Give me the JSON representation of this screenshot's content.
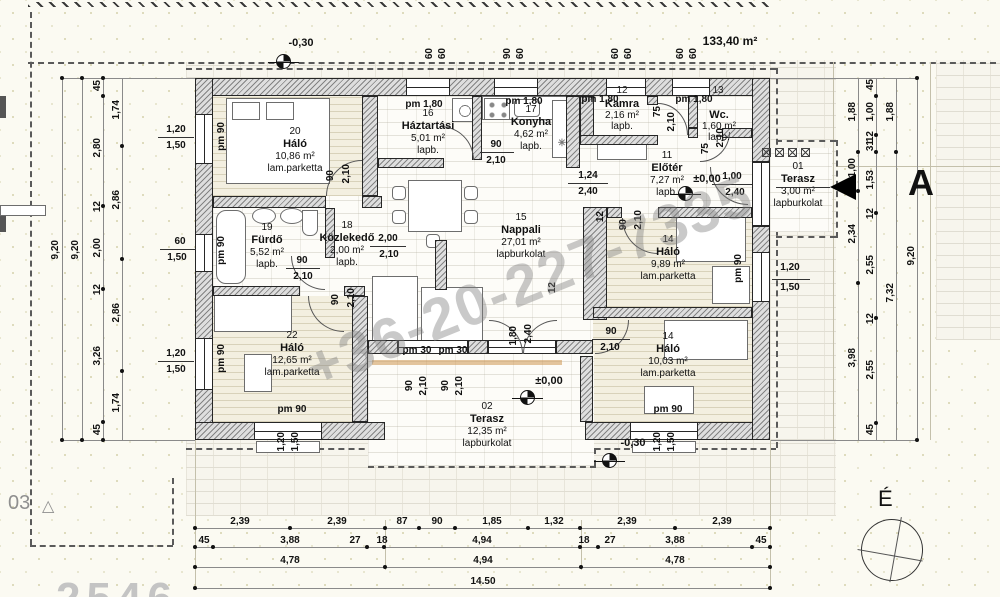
{
  "meta": {
    "area_total": "133,40 m²"
  },
  "levels": {
    "minus": "-0,30",
    "zero": "±0,00"
  },
  "watermark": "+36-20-227-7335",
  "marks": {
    "section": "A",
    "north": "É",
    "corner": "03",
    "partial": "2546"
  },
  "icons": {
    "triangle": "△",
    "boiler": "✳"
  },
  "rooms": {
    "r20": {
      "num": "20",
      "name": "Háló",
      "area": "10,86 m²",
      "floor": "lam.parketta"
    },
    "r16": {
      "num": "16",
      "name": "Háztartási",
      "area": "5,01 m²",
      "floor": "lapb."
    },
    "r17": {
      "num": "17",
      "name": "Konyha",
      "area": "4,62 m²",
      "floor": "lapb."
    },
    "r12": {
      "num": "12",
      "name": "Kamra",
      "area": "2,16 m²",
      "floor": "lapb."
    },
    "r13": {
      "num": "13",
      "name": "Wc.",
      "area": "1,60 m²",
      "floor": "lapb."
    },
    "r11": {
      "num": "11",
      "name": "Előtér",
      "area": "7,27 m²",
      "floor": "lapb."
    },
    "r15": {
      "num": "15",
      "name": "Nappali",
      "area": "27,01 m²",
      "floor": "lapburkolat"
    },
    "r19": {
      "num": "19",
      "name": "Fürdő",
      "area": "5,52 m²",
      "floor": "lapb."
    },
    "r18": {
      "num": "18",
      "name": "Közlekedő",
      "area": "2,00 m²",
      "floor": "lapb."
    },
    "r22": {
      "num": "22",
      "name": "Háló",
      "area": "12,65 m²",
      "floor": "lam.parketta"
    },
    "r14a": {
      "num": "14",
      "name": "Háló",
      "area": "9,89 m²",
      "floor": "lam.parketta"
    },
    "r14b": {
      "num": "14",
      "name": "Háló",
      "area": "10,03 m²",
      "floor": "lam.parketta"
    },
    "t01": {
      "num": "01",
      "name": "Terasz",
      "area": "3,00 m²",
      "floor": "lapburkolat"
    },
    "t02": {
      "num": "02",
      "name": "Terasz",
      "area": "12,35 m²",
      "floor": "lapburkolat"
    }
  },
  "op": {
    "w90": "90",
    "h210": "2,10",
    "w75": "75",
    "w100": "1,00",
    "h240": "2,40",
    "w180": "1,80",
    "w124": "1,24",
    "w200": "2,00",
    "pm90": "pm 90",
    "pm180": "pm 1,80",
    "pm30": "pm 30",
    "wall12": "12"
  },
  "dims": {
    "left": {
      "total_a": "9,20",
      "total_b": "9,20",
      "chain": [
        "45",
        "2,80",
        "12",
        "2,00",
        "12",
        "3,26",
        "45"
      ],
      "rooms": [
        "1,74",
        "2,86",
        "2,86",
        "1,74"
      ],
      "win": [
        [
          "1,20",
          "1,50"
        ],
        [
          "60",
          "1,50"
        ],
        [
          "1,20",
          "1,50"
        ]
      ]
    },
    "right": {
      "outer": [
        "1,88",
        "1,00",
        "2,34",
        "3,98"
      ],
      "chain": [
        "45",
        "1,00",
        "12",
        "31",
        "1,53",
        "12",
        "2,55",
        "12",
        "2,55",
        "45"
      ],
      "mid": [
        "1,88",
        "7,32"
      ],
      "total": "9,20",
      "win": [
        "1,20",
        "1,50"
      ]
    },
    "bottom": {
      "row1": [
        "2,39",
        "2,39",
        "87",
        "90",
        "1,85",
        "1,32",
        "2,39",
        "2,39"
      ],
      "row2": [
        "45",
        "3,88",
        "27",
        "18",
        "4,94",
        "18",
        "27",
        "3,88",
        "45"
      ],
      "row3": [
        "4,78",
        "4,94",
        "4,78"
      ],
      "total": "14.50",
      "win22": [
        "1,20",
        "1,50"
      ],
      "win14": [
        "1,20",
        "1,50"
      ]
    },
    "top": {
      "pairs": [
        [
          "60",
          "60"
        ],
        [
          "90",
          "60"
        ],
        [
          "60",
          "60"
        ],
        [
          "60",
          "60"
        ]
      ]
    }
  }
}
